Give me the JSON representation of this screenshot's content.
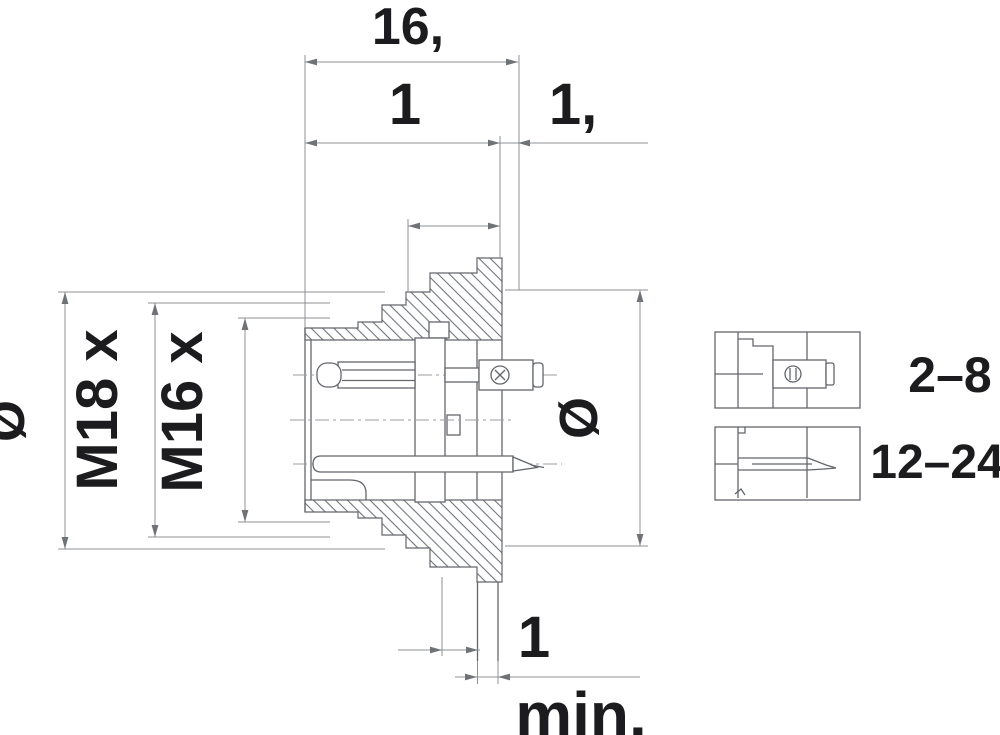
{
  "drawing": {
    "kind": "connector-flange-mount-cross-section",
    "colors": {
      "background": "#ffffff",
      "line": "#63666b",
      "dim_line": "#8e9196",
      "text": "#1c1c1e"
    },
    "dims": {
      "overall_width": "16,",
      "body_width": "1",
      "flange_thickness": "1,",
      "diameter_symbol_left": "Ø",
      "thread_outer": "M18 x",
      "thread_inner": "M16 x",
      "diameter_symbol_right": "Ø",
      "terminal_dim": "1",
      "terminal_dim_suffix": "min."
    },
    "contact_details": [
      {
        "label": "2–8"
      },
      {
        "label": "12–24"
      }
    ]
  }
}
